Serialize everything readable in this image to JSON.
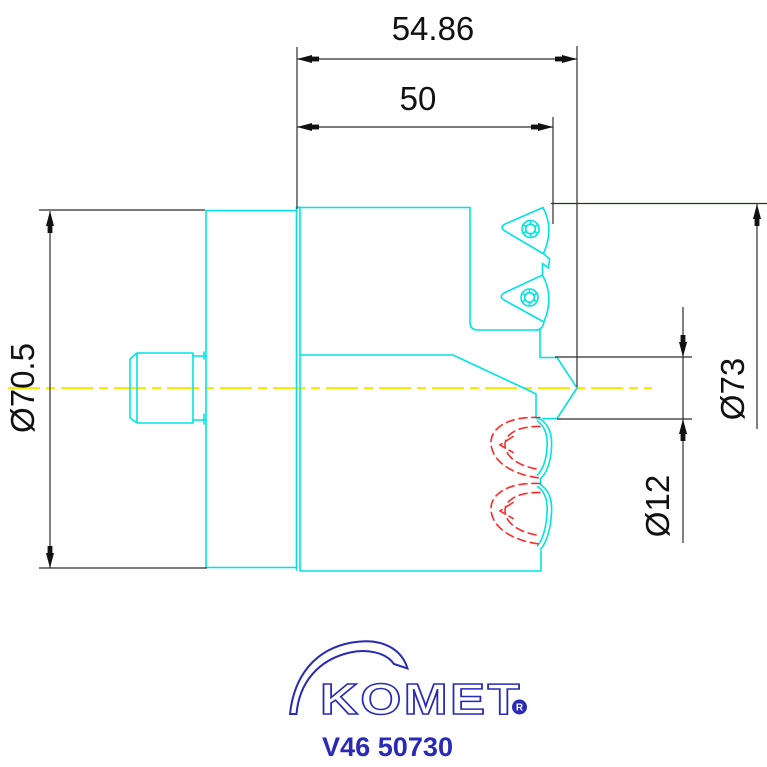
{
  "dimensions": {
    "overall_length": "54.86",
    "head_length": "50",
    "shank_diameter": "Ø70.5",
    "cutting_diameter": "Ø73",
    "pilot_diameter": "Ø12"
  },
  "logo": {
    "brand": "KOMET",
    "registered_mark": "R",
    "part_number": "V46 50730"
  },
  "colors": {
    "geometry": "#00e4e4",
    "centerline": "#ffe800",
    "hidden_lines": "#ff2b2b",
    "dimension_lines": "#2f2f2f",
    "text": "#111111",
    "logo_blue": "#2a2ab8",
    "background": "#fdfefd"
  }
}
